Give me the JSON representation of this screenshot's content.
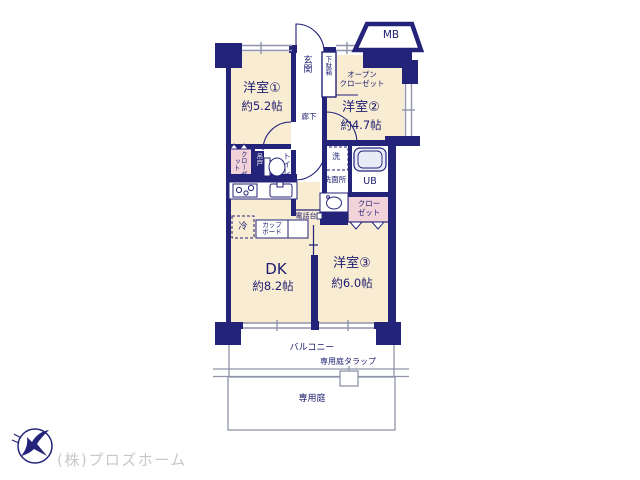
{
  "colors": {
    "wall": "#23237a",
    "text": "#1c1c70",
    "room_fill": "#f8ecd2",
    "closet_fill": "#f3d3da",
    "tub_fill": "#e8ecf6",
    "outline_gray": "#8f94aa",
    "company_text": "#c8c8c8"
  },
  "rooms": {
    "room1": {
      "label": "洋室①",
      "size": "約5.2帖"
    },
    "room2": {
      "label": "洋室②",
      "size": "約4.7帖"
    },
    "room3": {
      "label": "洋室③",
      "size": "約6.0帖"
    },
    "dk": {
      "label": "DK",
      "size": "約8.2帖"
    }
  },
  "labels": {
    "entrance": "玄関",
    "shoe_box": "下駄箱",
    "meter_box": "MB",
    "open_closet": "オープン\nクローゼット",
    "hallway": "廊下",
    "closet_left": "クローゼット",
    "hanging_door": "吊戸",
    "toilet": "トイレ",
    "washer": "洗",
    "washroom": "洗面所",
    "unit_bath": "UB",
    "closet_right": "クロー\nゼット",
    "phone_stand": "電話台",
    "fridge": "冷",
    "cupboard": "カップ\nボード",
    "balcony": "バルコニー",
    "garden_ladder": "専用庭タラップ",
    "private_garden": "専用庭"
  },
  "footer": {
    "company": "(株)プロズホーム"
  }
}
